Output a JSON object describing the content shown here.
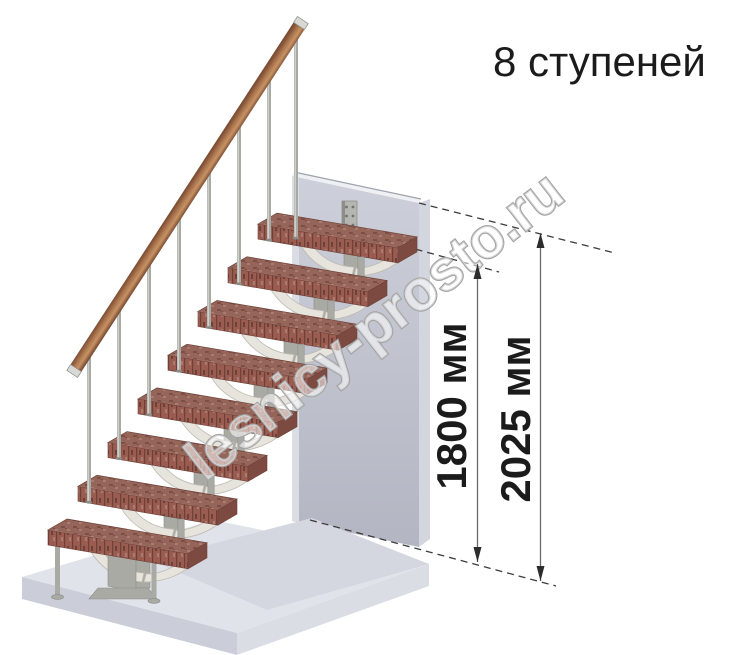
{
  "title": "8 ступеней",
  "watermark": "lesnicy-prosto.ru",
  "steps_count": 8,
  "dimensions": {
    "step_level": {
      "label": "1800 мм"
    },
    "floor_level": {
      "label": "2025 мм"
    }
  },
  "colors": {
    "background": "#ffffff",
    "tread_top": "#96655a",
    "tread_speckle_dark": "#7d4e45",
    "tread_speckle_light": "#a87c70",
    "tread_front": "#9a5c50",
    "tread_front_dark": "#6e4038",
    "tread_side": "#7c4a41",
    "tread_edge": "#c59a8b",
    "rail_dark": "#7d4e35",
    "rail_mid": "#b07a52",
    "rail_light": "#c79264",
    "rail_end": "#6e422c",
    "metal": "#aaaaa5",
    "metal_light": "#d8d8d4",
    "metal_dark": "#8c8c87",
    "support": "#e6e4dc",
    "support_shade": "#bdbab1",
    "wall_top": "#cdd0da",
    "wall_bottom": "#b3b6c2",
    "wall_side": "#d3d6de",
    "wall_edge": "#9fa2ad",
    "wall_highlight": "#dadde4",
    "wall_sliver": "#eef0f4",
    "platform_top": "#e1e3ea",
    "platform_band": "#d5d7e0",
    "platform_front_left": "#cbced8",
    "platform_front_right": "#dbdde5",
    "bracket": "#b5b6b1",
    "bracket_edge": "#8e8e89",
    "bracket_hole": "#74746f",
    "dash_line": "#3c3c3c",
    "dim_line": "#6a6a6a",
    "dim_arrow": "#2c2c2c",
    "text": "#1b1b1b",
    "watermark_fill": "rgba(255,255,255,0.55)",
    "watermark_stroke": "#a3a3a3"
  }
}
